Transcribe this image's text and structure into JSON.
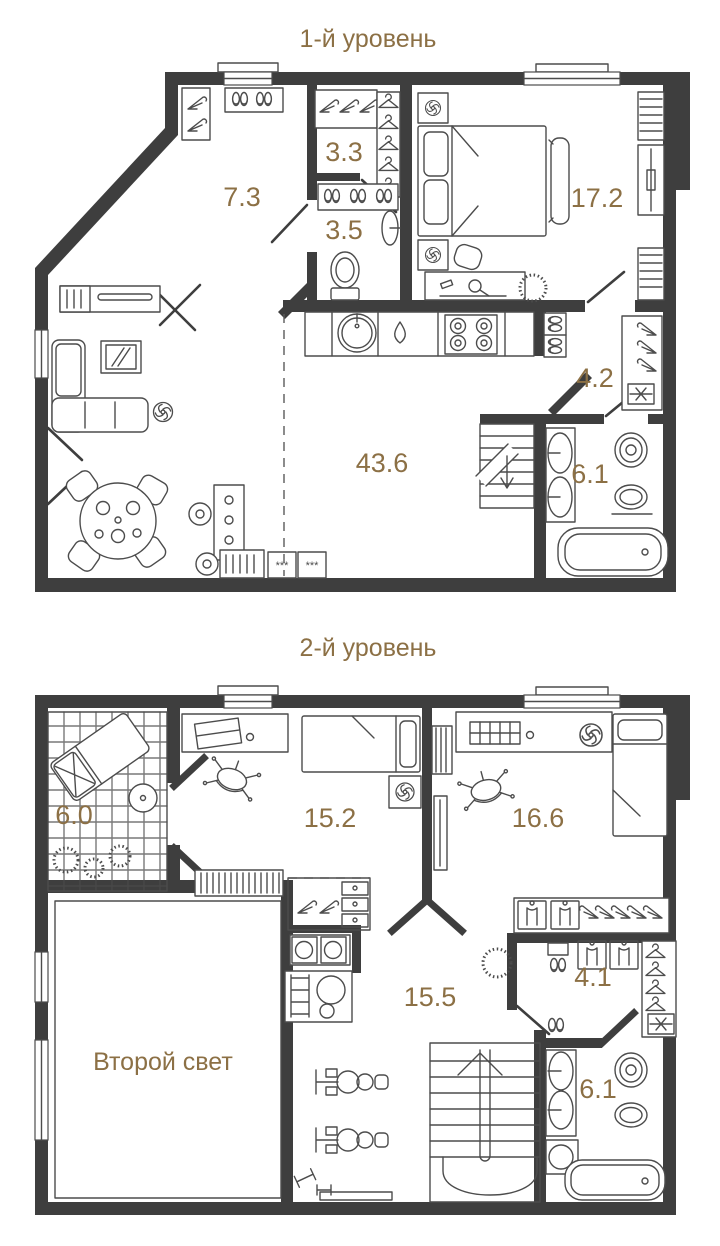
{
  "colors": {
    "wall": "#3e3e3e",
    "furniture_line": "#4c4c4c",
    "accent": "#8c7045",
    "background": "#ffffff"
  },
  "levels": [
    {
      "title": "1-й уровень",
      "rooms": [
        {
          "name": "hallway",
          "area": "7.3"
        },
        {
          "name": "wardrobe",
          "area": "3.3"
        },
        {
          "name": "wc",
          "area": "3.5"
        },
        {
          "name": "bedroom",
          "area": "17.2"
        },
        {
          "name": "walk-in-closet",
          "area": "4.2"
        },
        {
          "name": "living-kitchen",
          "area": "43.6"
        },
        {
          "name": "bathroom",
          "area": "6.1"
        }
      ]
    },
    {
      "title": "2-й уровень",
      "rooms": [
        {
          "name": "terrace",
          "area": "6.0"
        },
        {
          "name": "bedroom-2",
          "area": "15.2"
        },
        {
          "name": "bedroom-3",
          "area": "16.6"
        },
        {
          "name": "hall",
          "area": "15.5"
        },
        {
          "name": "walk-in-closet-2",
          "area": "4.1"
        },
        {
          "name": "bathroom-2",
          "area": "6.1"
        }
      ],
      "void_label": "Второй свет"
    }
  ]
}
